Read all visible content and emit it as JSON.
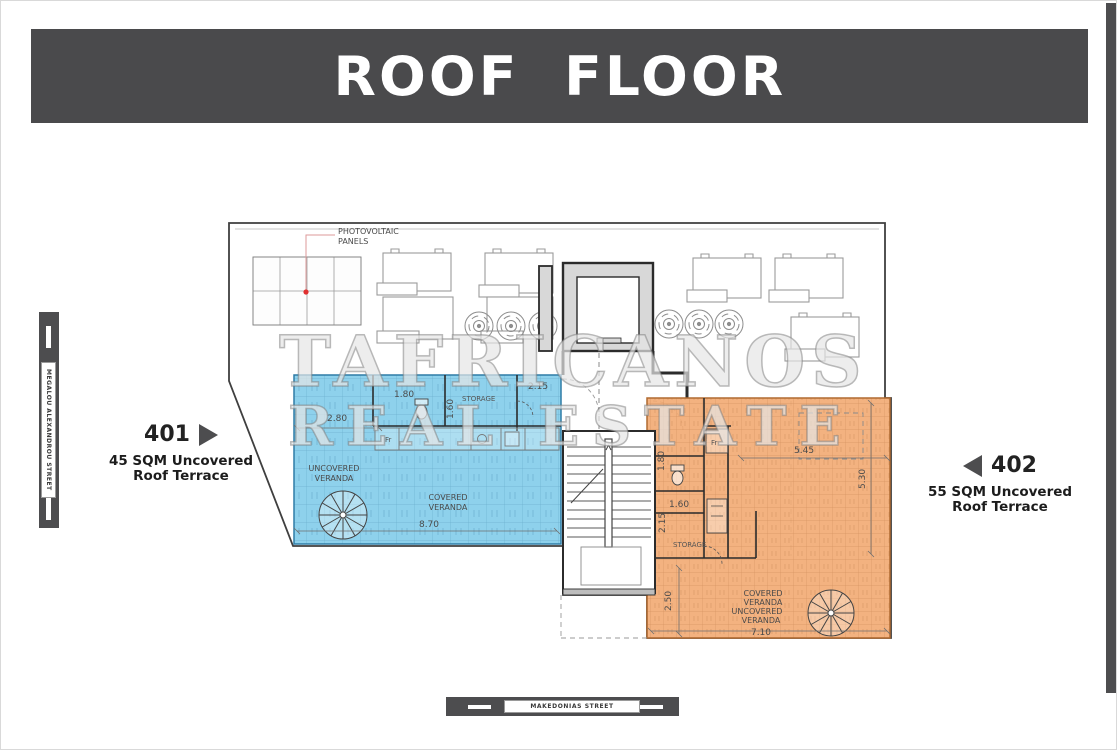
{
  "title": "ROOF FLOOR",
  "watermark": {
    "line1": "TAFRICANOS",
    "line2": "REAL ESTATE"
  },
  "streets": {
    "left": "MEGALOU ALEXANDROU STREET",
    "bottom": "MAKEDONIAS STREET"
  },
  "units": {
    "u401": {
      "number": "401",
      "desc_line1": "45 SQM Uncovered",
      "desc_line2": "Roof Terrace"
    },
    "u402": {
      "number": "402",
      "desc_line1": "55 SQM Uncovered",
      "desc_line2": "Roof Terrace"
    }
  },
  "plan": {
    "photovoltaic_line1": "PHOTOVOLTAIC",
    "photovoltaic_line2": "PANELS",
    "blue_unit": {
      "uncovered_line1": "UNCOVERED",
      "uncovered_line2": "VERANDA",
      "covered_line1": "COVERED",
      "covered_line2": "VERANDA",
      "storage": "STORAGE",
      "fridge": "Fr",
      "dims": {
        "d280": "2.80",
        "d180": "1.80",
        "d160": "1.60",
        "d215": "2.15",
        "d870": "8.70"
      }
    },
    "orange_unit": {
      "covered_line1": "COVERED",
      "covered_line2": "VERANDA",
      "uncovered_line1": "UNCOVERED",
      "uncovered_line2": "VERANDA",
      "storage": "STORAGE",
      "fridge": "Fr",
      "dims": {
        "d180": "1.80",
        "d545": "5.45",
        "d530": "5.30",
        "d160": "1.60",
        "d215": "2.15",
        "d250": "2.50",
        "d710": "7.10"
      }
    }
  },
  "colors": {
    "title_bar": "#4a4a4c",
    "street_bar": "#4d4d4f",
    "blue_fill": "#7ecbe9",
    "blue_stroke": "#2e7ca6",
    "orange_fill": "#f2aa72",
    "orange_stroke": "#b06a30",
    "red_marker": "#e03030",
    "plan_line": "#3f3f3f"
  }
}
